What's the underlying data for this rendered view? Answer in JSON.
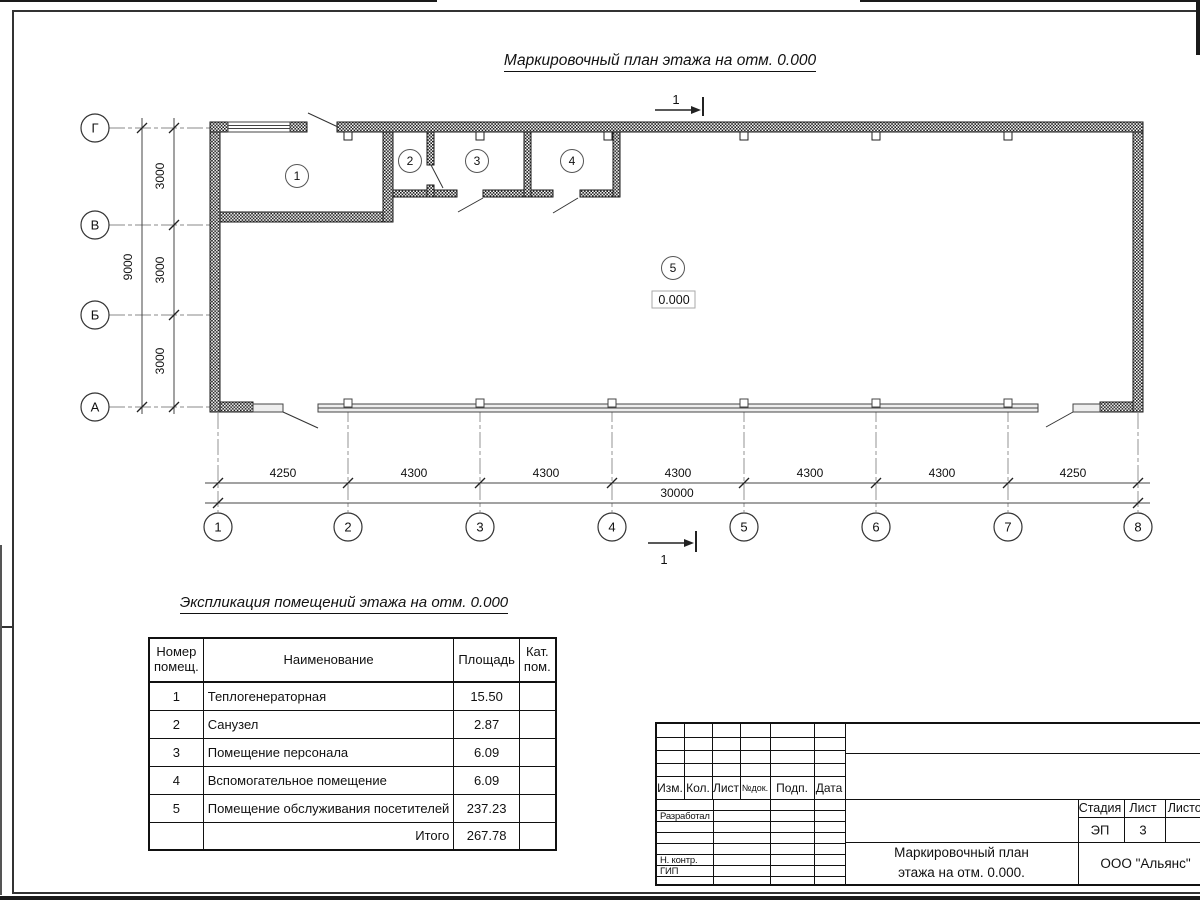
{
  "drawing": {
    "plan_title": "Маркировочный план этажа на отм. 0.000",
    "section_label": "1",
    "elevation": "0.000",
    "axes_letters": [
      "Г",
      "В",
      "Б",
      "А"
    ],
    "axes_numbers": [
      "1",
      "2",
      "3",
      "4",
      "5",
      "6",
      "7",
      "8"
    ],
    "dims_left": [
      "3000",
      "3000",
      "3000"
    ],
    "dim_left_total": "9000",
    "dims_bottom": [
      "4250",
      "4300",
      "4300",
      "4300",
      "4300",
      "4300",
      "4250"
    ],
    "dim_bottom_total": "30000",
    "rooms": [
      "1",
      "2",
      "3",
      "4",
      "5"
    ]
  },
  "explication": {
    "title": "Экспликация помещений этажа на отм. 0.000",
    "headers": [
      "Номер помещ.",
      "Наименование",
      "Площадь",
      "Кат. пом."
    ],
    "rows": [
      {
        "num": "1",
        "name": "Теплогенераторная",
        "area": "15.50",
        "cat": ""
      },
      {
        "num": "2",
        "name": "Санузел",
        "area": "2.87",
        "cat": ""
      },
      {
        "num": "3",
        "name": "Помещение персонала",
        "area": "6.09",
        "cat": ""
      },
      {
        "num": "4",
        "name": "Вспомогательное помещение",
        "area": "6.09",
        "cat": ""
      },
      {
        "num": "5",
        "name": "Помещение обслуживания посетителей",
        "area": "237.23",
        "cat": ""
      }
    ],
    "total_label": "Итого",
    "total_area": "267.78"
  },
  "titleblock": {
    "header_cols": [
      "Изм.",
      "Кол.",
      "Лист",
      "№док.",
      "Подп.",
      "Дата"
    ],
    "roles": [
      "Разработал",
      "Н. контр.",
      "ГИП"
    ],
    "stage_label": "Стадия",
    "sheet_label": "Лист",
    "sheets_label": "Листов",
    "stage_value": "ЭП",
    "sheet_value": "3",
    "doc_title_line1": "Маркировочный план",
    "doc_title_line2": "этажа на отм. 0.000.",
    "company": "ООО \"Альянс\""
  }
}
